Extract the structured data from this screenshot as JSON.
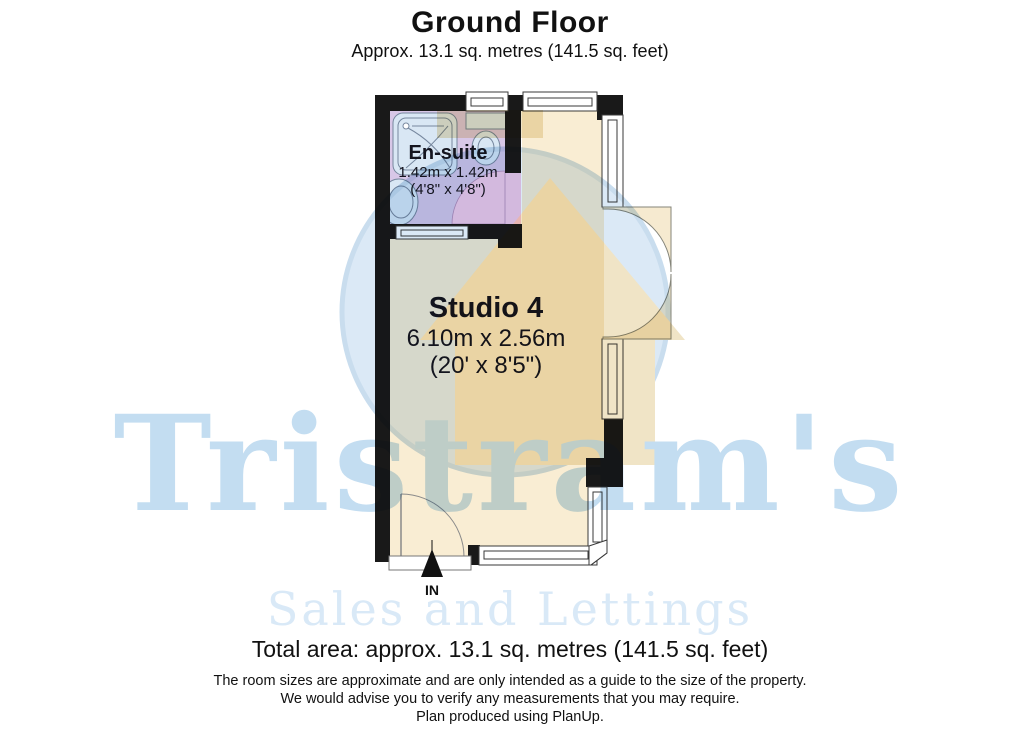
{
  "header": {
    "title": "Ground Floor",
    "subtitle": "Approx. 13.1 sq. metres (141.5 sq. feet)"
  },
  "rooms": {
    "ensuite": {
      "name": "En-suite",
      "dimensions_metric": "1.42m x 1.42m",
      "dimensions_imperial": "(4'8\" x 4'8\")"
    },
    "studio": {
      "name": "Studio 4",
      "dimensions_metric": "6.10m x 2.56m",
      "dimensions_imperial": "(20' x 8'5\")"
    }
  },
  "entrance": {
    "label": "IN"
  },
  "footer": {
    "total_area": "Total area: approx. 13.1 sq. metres (141.5 sq. feet)",
    "disclaimer": [
      "The room sizes are approximate and are only intended as a guide to the size of the property.",
      "We would advise you to verify any measurements that you may require.",
      "Plan produced using PlanUp."
    ]
  },
  "watermark": {
    "brand": "Tristram's",
    "tagline": "Sales and Lettings"
  },
  "colors": {
    "wall": "#191919",
    "studio_floor": "#f9edd3",
    "ensuite_floor": "#d8c7e7",
    "door_swing_pink": "#f6cbe6",
    "fixture_blue": "#d9e7f4",
    "door_leaf_cream": "#f6ead0",
    "window_white": "#ffffff",
    "watermark_blue": "#dbe9f6",
    "watermark_tan": "#f0e4c6",
    "watermark_text": "#c3ddf1",
    "watermark_tagline": "#d9e9f7"
  }
}
